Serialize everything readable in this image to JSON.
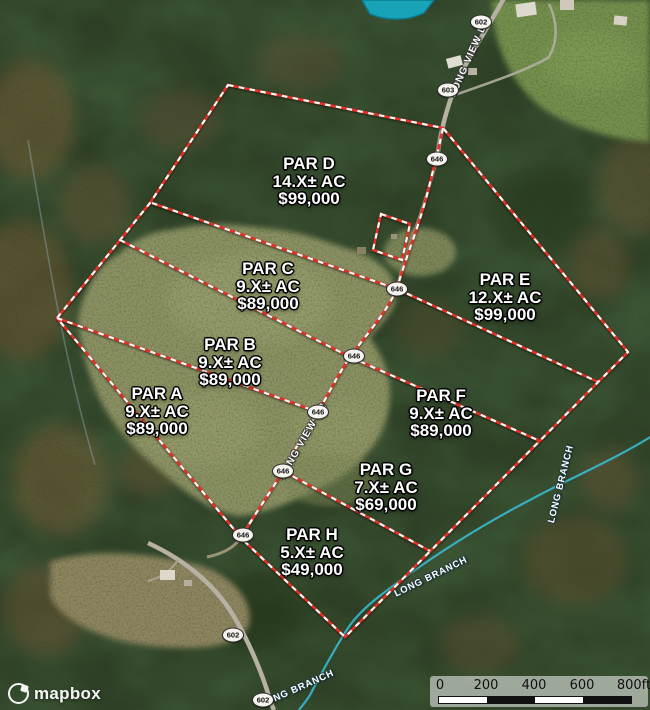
{
  "attribution": {
    "logo_text": "mapbox"
  },
  "scale_bar": {
    "labels": [
      "0",
      "200",
      "400",
      "600",
      "800ft"
    ]
  },
  "parcels": [
    {
      "name": "PAR A",
      "acres": "9.X± AC",
      "price": "$89,000"
    },
    {
      "name": "PAR B",
      "acres": "9.X± AC",
      "price": "$89,000"
    },
    {
      "name": "PAR C",
      "acres": "9.X± AC",
      "price": "$89,000"
    },
    {
      "name": "PAR D",
      "acres": "14.X± AC",
      "price": "$99,000"
    },
    {
      "name": "PAR E",
      "acres": "12.X± AC",
      "price": "$99,000"
    },
    {
      "name": "PAR F",
      "acres": "9.X± AC",
      "price": "$89,000"
    },
    {
      "name": "PAR G",
      "acres": "7.X± AC",
      "price": "$69,000"
    },
    {
      "name": "PAR H",
      "acres": "5.X± AC",
      "price": "$49,000"
    }
  ],
  "roads": {
    "long_view_dr_upper": "LONG VIEW DR",
    "long_view_dr_lower": "LONG VIEW DR"
  },
  "streams": {
    "long_branch": "LONG BRANCH"
  },
  "route_shields": [
    {
      "number": "602"
    },
    {
      "number": "603"
    },
    {
      "number": "646"
    },
    {
      "number": "646"
    },
    {
      "number": "646"
    },
    {
      "number": "646"
    },
    {
      "number": "646"
    },
    {
      "number": "646"
    },
    {
      "number": "602"
    },
    {
      "number": "602"
    }
  ],
  "colors": {
    "boundary_red": "#e23127",
    "stream_teal": "#38b3c6",
    "forest_green": "#2e3f26",
    "field_olive": "#8c9164"
  }
}
